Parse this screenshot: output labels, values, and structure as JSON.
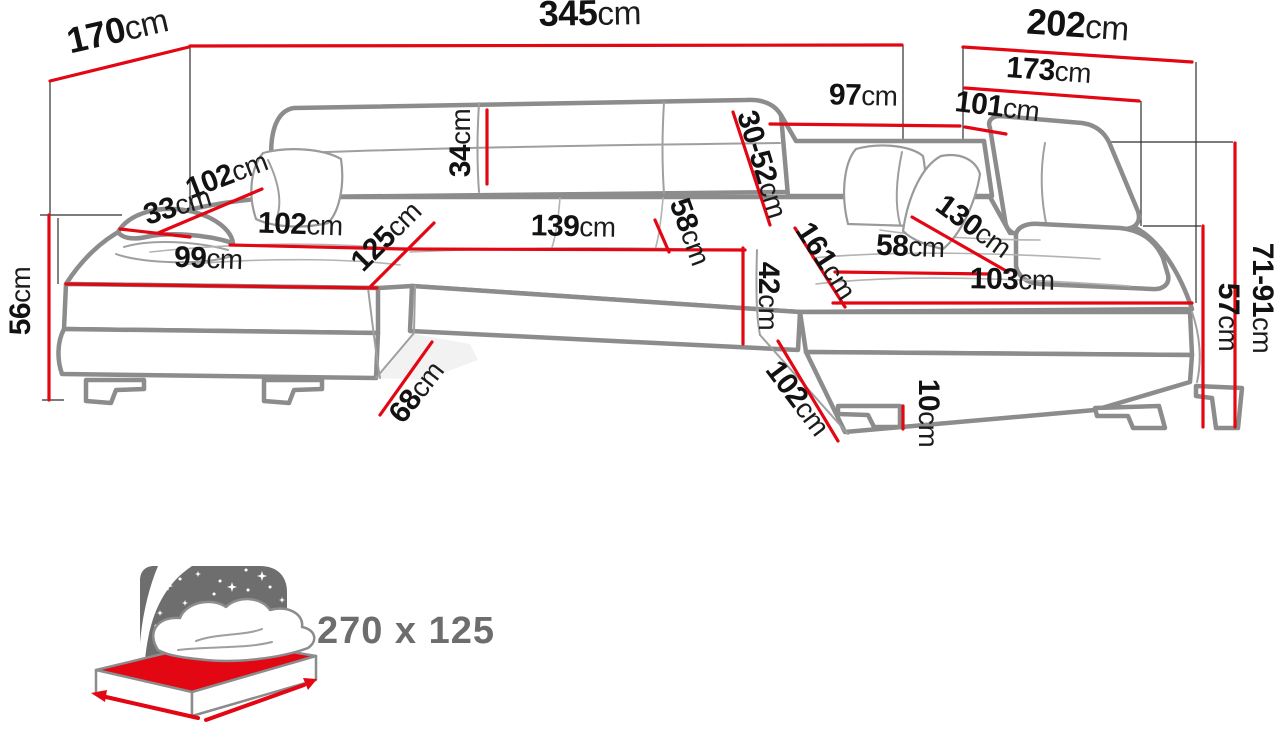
{
  "diagram": {
    "type": "corner-sofa-dimension-diagram",
    "colors": {
      "dimension_red": "#e30613",
      "outline_gray": "#8c8c8c",
      "label_black": "#121212",
      "icon_gray": "#6e6e6e",
      "mattress_red": "#e30613"
    },
    "dimensions": {
      "total_width": {
        "value": "345",
        "unit": "cm"
      },
      "left_side_depth": {
        "value": "170",
        "unit": "cm"
      },
      "right_side_depth": {
        "value": "202",
        "unit": "cm"
      },
      "right_inner_depth": {
        "value": "173",
        "unit": "cm"
      },
      "back_section_width": {
        "value": "97",
        "unit": "cm"
      },
      "corner_section_width": {
        "value": "101",
        "unit": "cm"
      },
      "backrest_cushion_height": {
        "value": "34",
        "unit": "cm"
      },
      "adjustable_headrest_range": {
        "value": "30-52",
        "unit": "cm"
      },
      "left_arm_back_diagonal": {
        "value": "102",
        "unit": "cm"
      },
      "armrest_top_width": {
        "value": "33",
        "unit": "cm"
      },
      "left_seat_length": {
        "value": "102",
        "unit": "cm"
      },
      "left_chaise_front_width": {
        "value": "99",
        "unit": "cm"
      },
      "left_chaise_depth": {
        "value": "125",
        "unit": "cm"
      },
      "middle_seat_width": {
        "value": "139",
        "unit": "cm"
      },
      "middle_seat_depth": {
        "value": "58",
        "unit": "cm"
      },
      "seat_height": {
        "value": "42",
        "unit": "cm"
      },
      "right_seat_length": {
        "value": "161",
        "unit": "cm"
      },
      "right_seat_depth": {
        "value": "58",
        "unit": "cm"
      },
      "right_chaise_diagonal": {
        "value": "130",
        "unit": "cm"
      },
      "right_chaise_front_width": {
        "value": "103",
        "unit": "cm"
      },
      "left_side_height": {
        "value": "56",
        "unit": "cm"
      },
      "left_gap_diagonal": {
        "value": "68",
        "unit": "cm"
      },
      "right_gap_diagonal": {
        "value": "102",
        "unit": "cm"
      },
      "leg_height": {
        "value": "10",
        "unit": "cm"
      },
      "back_height_range": {
        "value": "71-91",
        "unit": "cm"
      },
      "armrest_height": {
        "value": "57",
        "unit": "cm"
      }
    },
    "sleeping_area": {
      "label": "270 x 125"
    }
  }
}
